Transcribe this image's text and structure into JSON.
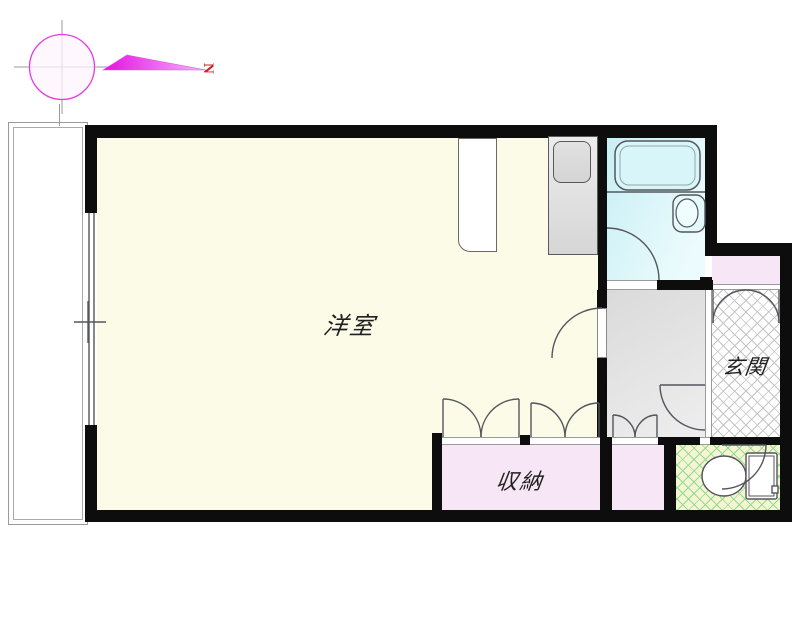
{
  "compass": {
    "north_label": "N"
  },
  "rooms": {
    "main": {
      "label": "洋室"
    },
    "storage": {
      "label": "収納"
    },
    "entrance": {
      "label": "玄関"
    }
  },
  "colors": {
    "wall": "#0d0d0d",
    "main_room": "#fbfbe7",
    "closet_pink": "#f7e6f5",
    "bath_top": "#c7eff5",
    "hallway": "#ececec",
    "toilet_bg": "#f5f5d4",
    "toilet_hatch": "#8fdc8f",
    "entrance_hatch": "#c4c4c4",
    "line": "#54565c",
    "compass_magenta": "#e43ce4",
    "north_red": "#cc2222"
  }
}
